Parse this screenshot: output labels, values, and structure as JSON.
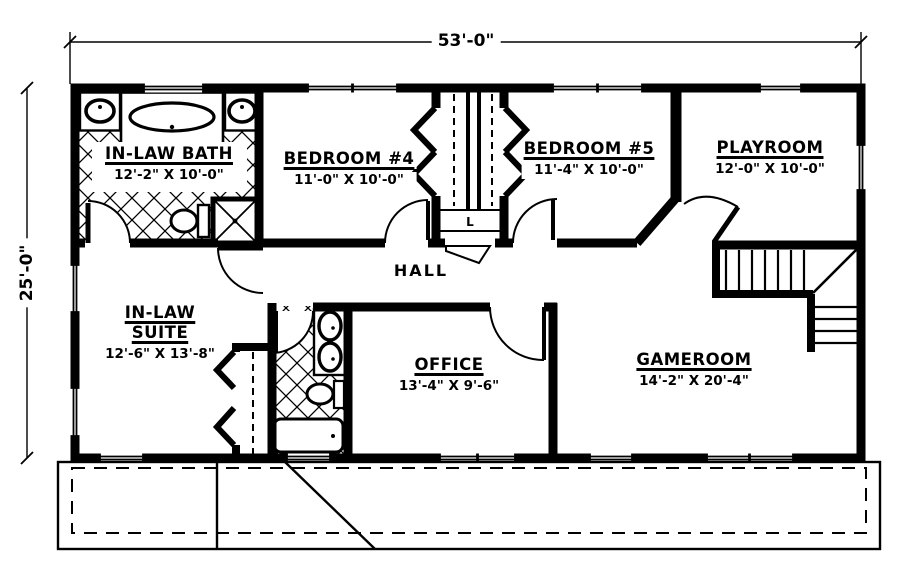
{
  "plan": {
    "overall_width_label": "53'-0\"",
    "overall_height_label": "25'-0\"",
    "rooms": [
      {
        "name": "IN-LAW BATH",
        "dims": "12'-2\" X 10'-0\""
      },
      {
        "name": "BEDROOM #4",
        "dims": "11'-0\" X 10'-0\""
      },
      {
        "name": "BEDROOM #5",
        "dims": "11'-4\" X 10'-0\""
      },
      {
        "name": "PLAYROOM",
        "dims": "12'-0\" X 10'-0\""
      },
      {
        "name": "IN-LAW\nSUITE",
        "dims": "12'-6\" X 13'-8\""
      },
      {
        "name": "OFFICE",
        "dims": "13'-4\" X 9'-6\""
      },
      {
        "name": "GAMEROOM",
        "dims": "14'-2\" X 20'-4\""
      }
    ],
    "hall_label": "HALL",
    "linen_closet_label": "L",
    "ink_color": "#000000",
    "paper_color": "#ffffff"
  }
}
